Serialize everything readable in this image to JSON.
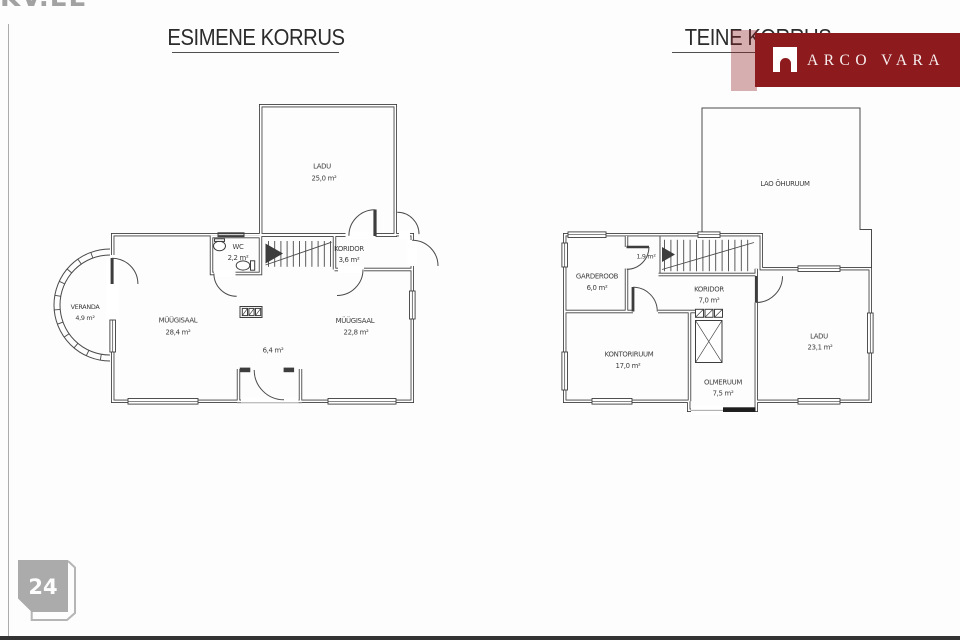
{
  "watermark": {
    "text": "KV.EE"
  },
  "brand": {
    "name": "ARCO VARA",
    "banner_color": "#8D1B1E",
    "logo_icon": "arch-icon"
  },
  "page": {
    "number": "24",
    "badge_color": "#ABABAB"
  },
  "left_plan": {
    "title": "ESIMENE KORRUS",
    "rooms": [
      {
        "name": "LADU",
        "area": "25,0 m²"
      },
      {
        "name": "WC",
        "area": "2,2 m²"
      },
      {
        "name": "KORIDOR",
        "area": "3,6 m²"
      },
      {
        "name": "VERANDA",
        "area": "4,9 m²"
      },
      {
        "name": "MÜÜGISAAL",
        "area": "28,4 m²"
      },
      {
        "name": "MÜÜGISAAL",
        "area": "22,8 m²"
      },
      {
        "name": "",
        "area": "6,4 m²"
      }
    ]
  },
  "right_plan": {
    "title": "TEINE KORRUS",
    "rooms": [
      {
        "name": "LAO ÕHURUUM",
        "area": ""
      },
      {
        "name": "GARDEROOB",
        "area": "6,0 m²"
      },
      {
        "name": "",
        "area": "1,9 m²"
      },
      {
        "name": "KORIDOR",
        "area": "7,0 m²"
      },
      {
        "name": "KONTORIRUUM",
        "area": "17,0 m²"
      },
      {
        "name": "OLMERUUM",
        "area": "7,5 m²"
      },
      {
        "name": "LADU",
        "area": "23,1 m²"
      }
    ]
  }
}
